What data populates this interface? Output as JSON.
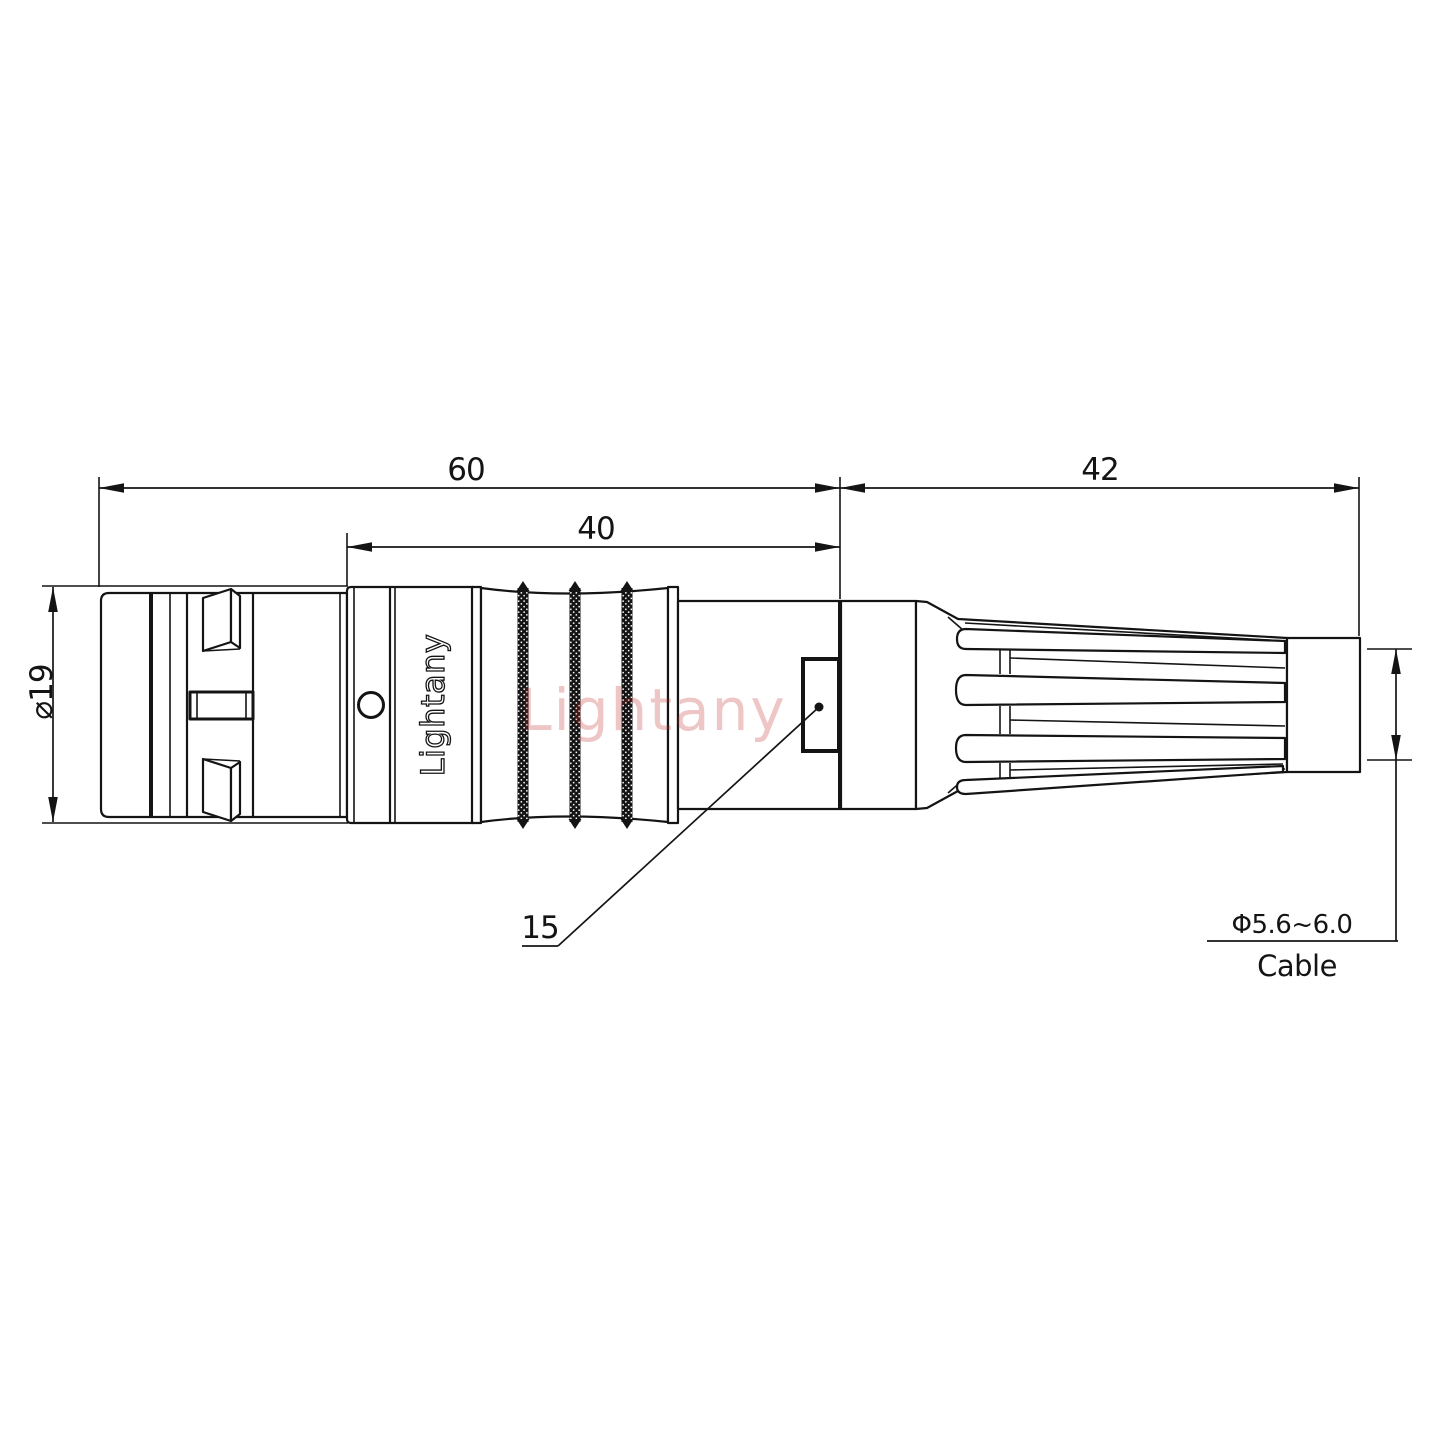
{
  "drawing": {
    "watermark": "Lightany",
    "engraving": "Lightany",
    "dims": {
      "total_length": "60",
      "body_length": "40",
      "boot_length": "42",
      "shell_diameter": "⌀19",
      "feature_size": "15",
      "cable_diameter": "Φ5.6~6.0",
      "cable_label": "Cable"
    }
  }
}
